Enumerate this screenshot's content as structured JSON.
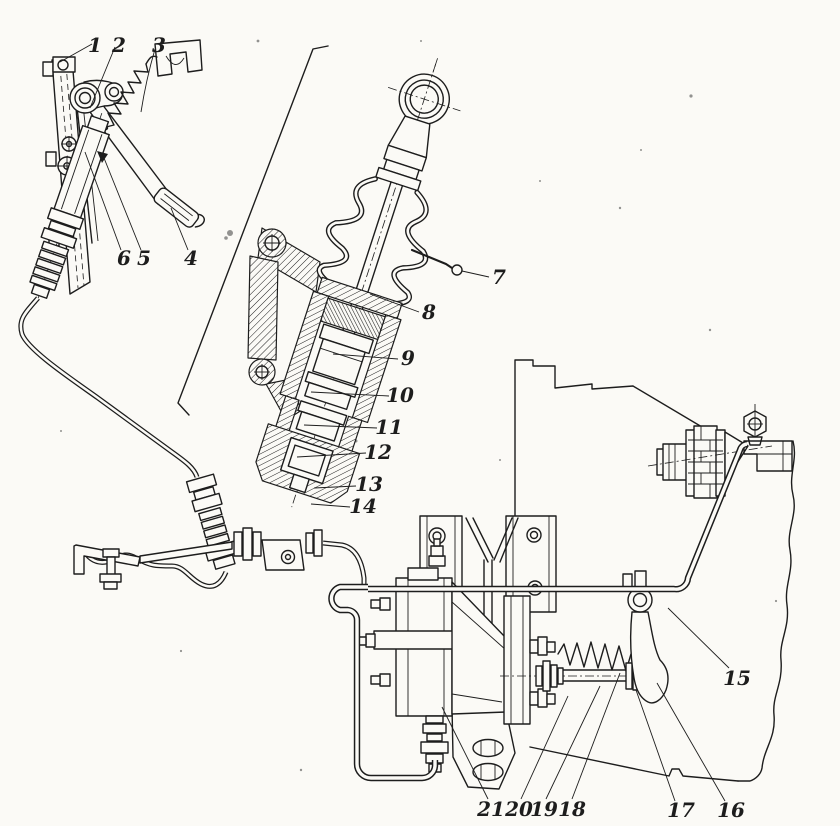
{
  "colors": {
    "paper": "#fbfaf6",
    "ink": "#1d1d1d"
  },
  "callouts": [
    {
      "number": "1"
    },
    {
      "number": "2"
    },
    {
      "number": "3"
    },
    {
      "number": "4"
    },
    {
      "number": "5"
    },
    {
      "number": "6"
    },
    {
      "number": "7"
    },
    {
      "number": "8"
    },
    {
      "number": "9"
    },
    {
      "number": "10"
    },
    {
      "number": "11"
    },
    {
      "number": "12"
    },
    {
      "number": "13"
    },
    {
      "number": "14"
    },
    {
      "number": "15"
    },
    {
      "number": "16"
    },
    {
      "number": "17"
    },
    {
      "number": "18"
    },
    {
      "number": "19"
    },
    {
      "number": "20"
    },
    {
      "number": "21"
    }
  ]
}
